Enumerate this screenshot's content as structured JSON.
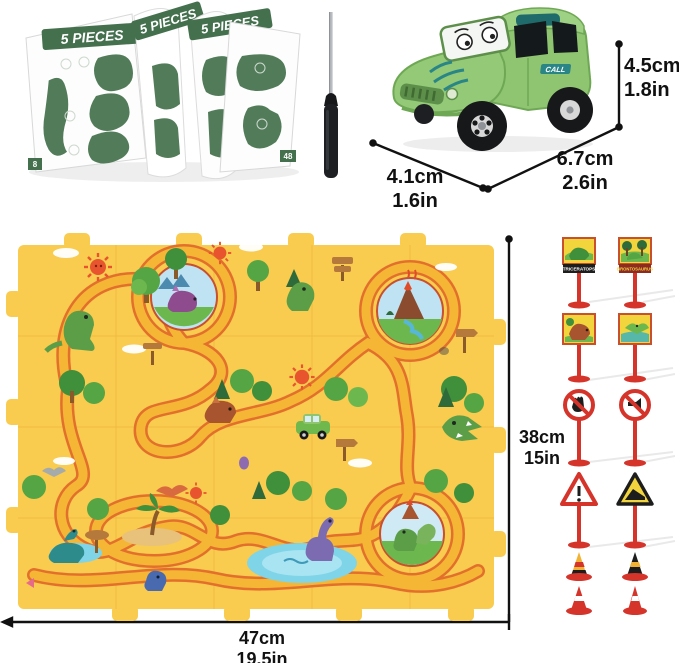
{
  "booklet": {
    "title": "5 PIECES",
    "page_number_left": "8",
    "page_number_right": "48"
  },
  "car": {
    "decal": "CALL"
  },
  "dimensions": {
    "car_height": {
      "cm": "4.5cm",
      "inch": "1.8in"
    },
    "car_length": {
      "cm": "6.7cm",
      "inch": "2.6in"
    },
    "car_width": {
      "cm": "4.1cm",
      "inch": "1.6in"
    },
    "mat_height": {
      "cm": "38cm",
      "inch": "15in"
    },
    "mat_width": {
      "cm": "47cm",
      "inch": "19.5in"
    }
  },
  "signs": {
    "triceratops_label": "TRICERATOPS",
    "brontosaurus_label": "BRONTOSAURUS"
  },
  "colors": {
    "mat_yellow": "#f9cb4e",
    "track_surface": "#f5b635",
    "track_edge": "#e2702c",
    "car_green": "#8fc571",
    "sign_red": "#d5342b",
    "booklet_green": "#44704e"
  }
}
